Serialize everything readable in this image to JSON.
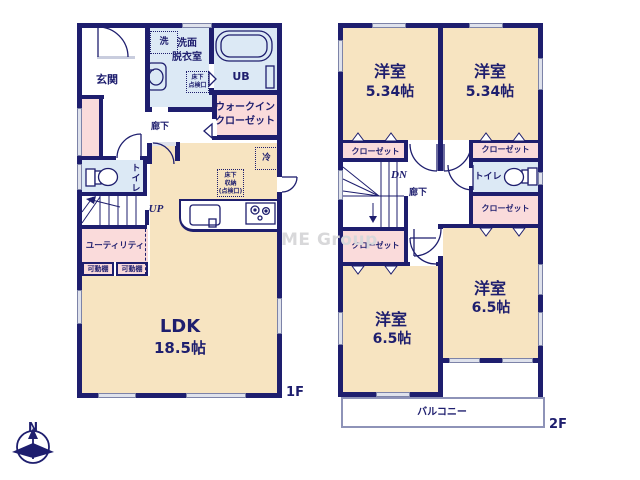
{
  "watermark": "ME Group",
  "compass_north": "N",
  "colors": {
    "wall": "#1e1e6e",
    "room_cream": "#f7e4c1",
    "room_pink": "#fadbdb",
    "room_blue": "#dce9f5",
    "window_gray": "#dfe2ec",
    "balcony_line": "#8e93b8",
    "watermark_gray": "#d8d8da"
  },
  "f1": {
    "floor_label": "1F",
    "genkan": "玄関",
    "washer": "洗",
    "washroom": [
      "洗面",
      "脱衣室"
    ],
    "hatch_small": [
      "床下",
      "点検口"
    ],
    "bath": "UB",
    "wic": [
      "ウォークイン",
      "クローゼット"
    ],
    "hall": "廊下",
    "toilet": "トイレ",
    "stairs": "UP",
    "utility": "ユーティリティ",
    "shelf_a": "可動棚",
    "shelf_b": "可動棚",
    "fridge": "冷",
    "floor_storage": [
      "床下",
      "収納",
      "(点検口)"
    ],
    "ldk": "LDK",
    "ldk_size": "18.5帖"
  },
  "f2": {
    "floor_label": "2F",
    "room_tl": "洋室",
    "room_tl_size": "5.34帖",
    "room_tr": "洋室",
    "room_tr_size": "5.34帖",
    "closet_tl": "クローゼット",
    "closet_tr": "クローゼット",
    "stairs": "DN",
    "hall": "廊下",
    "toilet": "トイレ",
    "closet_mr": "クローゼット",
    "closet_bl": "クローゼット",
    "room_bl": "洋室",
    "room_bl_size": "6.5帖",
    "room_br": "洋室",
    "room_br_size": "6.5帖",
    "balcony": "バルコニー"
  }
}
